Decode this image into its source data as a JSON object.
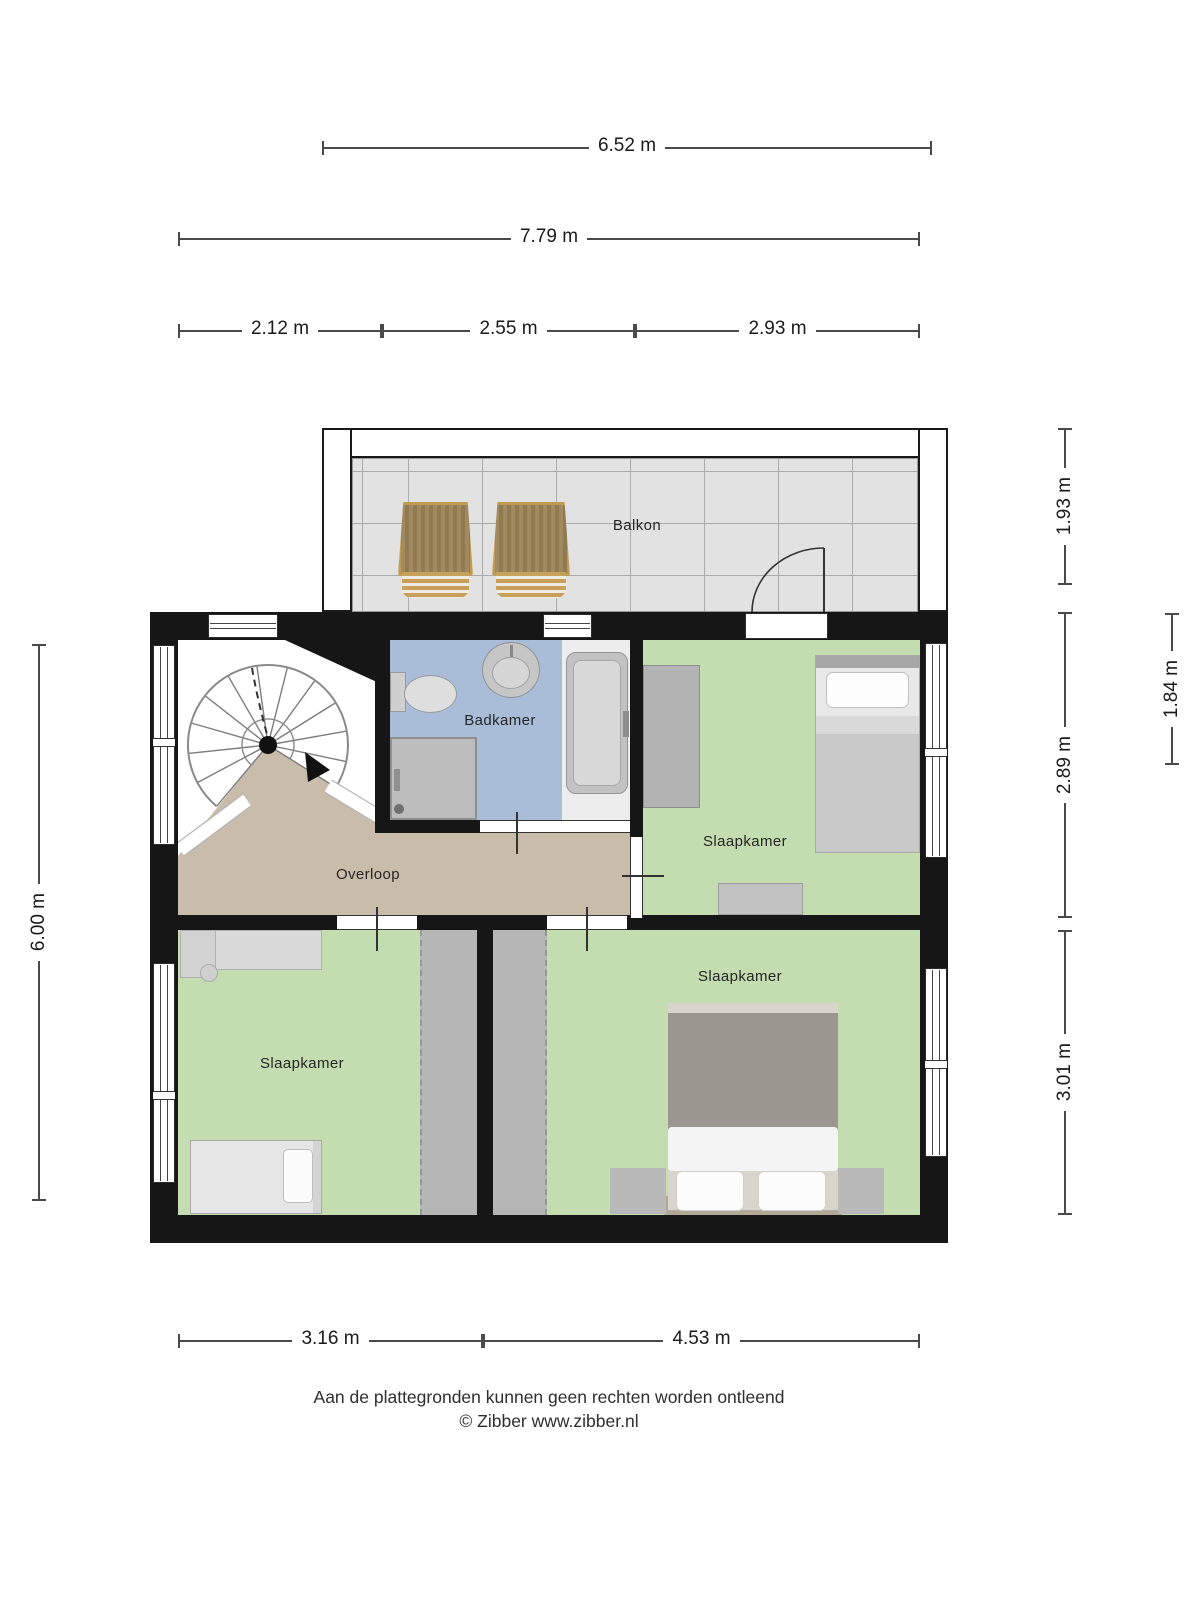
{
  "rooms": {
    "balcony": "Balkon",
    "bathroom": "Badkamer",
    "landing": "Overloop",
    "bedroom_top": "Slaapkamer",
    "bedroom_left": "Slaapkamer",
    "bedroom_right": "Slaapkamer"
  },
  "dimensions": {
    "balcony_width": "6.52 m",
    "total_width": "7.79 m",
    "width_left": "2.12 m",
    "width_mid": "2.55 m",
    "width_right": "2.93 m",
    "height_total": "6.00 m",
    "balcony_depth": "1.93 m",
    "bed_depth": "1.84 m",
    "upper_depth": "2.89 m",
    "lower_depth": "3.01 m",
    "bottom_left": "3.16 m",
    "bottom_right": "4.53 m"
  },
  "footer": {
    "disclaimer": "Aan de plattegronden kunnen geen rechten worden ontleend",
    "copyright": "© Zibber www.zibber.nl"
  },
  "colors": {
    "wall": "#161616",
    "bedroom_floor": "#c3dcb0",
    "bathroom_floor": "#a9bdd9",
    "landing_floor": "#c9bcab",
    "balcony_tile": "#e2e2e2",
    "knee_wall": "#b6b6b6",
    "chair_wood": "#c19a52"
  }
}
